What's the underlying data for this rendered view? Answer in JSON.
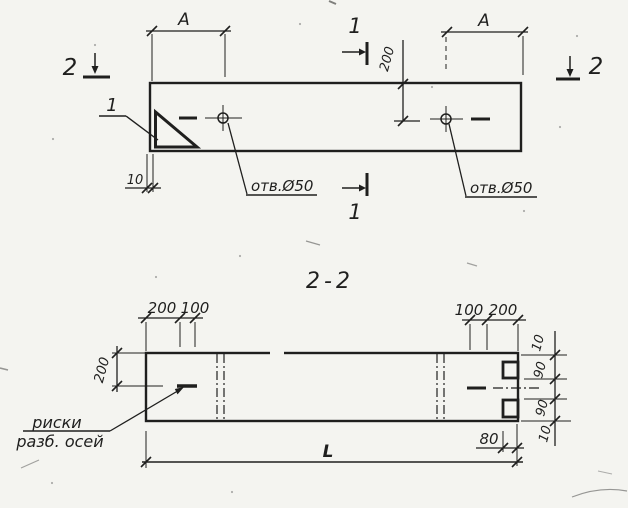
{
  "colors": {
    "ink": "#1f1f1e",
    "paper": "#f4f4f0"
  },
  "section_title": "2-2",
  "top_view": {
    "dim_a_left": "A",
    "dim_a_right": "A",
    "dim_200": "200",
    "dim_10": "10",
    "hole_label_left": "отв.Ø50",
    "hole_label_right": "отв.Ø50",
    "marker_1_top": "1",
    "marker_1_bottom": "1",
    "marker_2_left": "2",
    "marker_2_right": "2",
    "detail_label": "1"
  },
  "section_view": {
    "dims_top_left": [
      "200",
      "100"
    ],
    "dims_top_right": [
      "100",
      "200"
    ],
    "dim_height_left": "200",
    "dims_right": [
      "10",
      "90",
      "90",
      "10"
    ],
    "dim_80": "80",
    "dim_length": "L",
    "axis_note_line1": "риски",
    "axis_note_line2": "разб. осей"
  }
}
